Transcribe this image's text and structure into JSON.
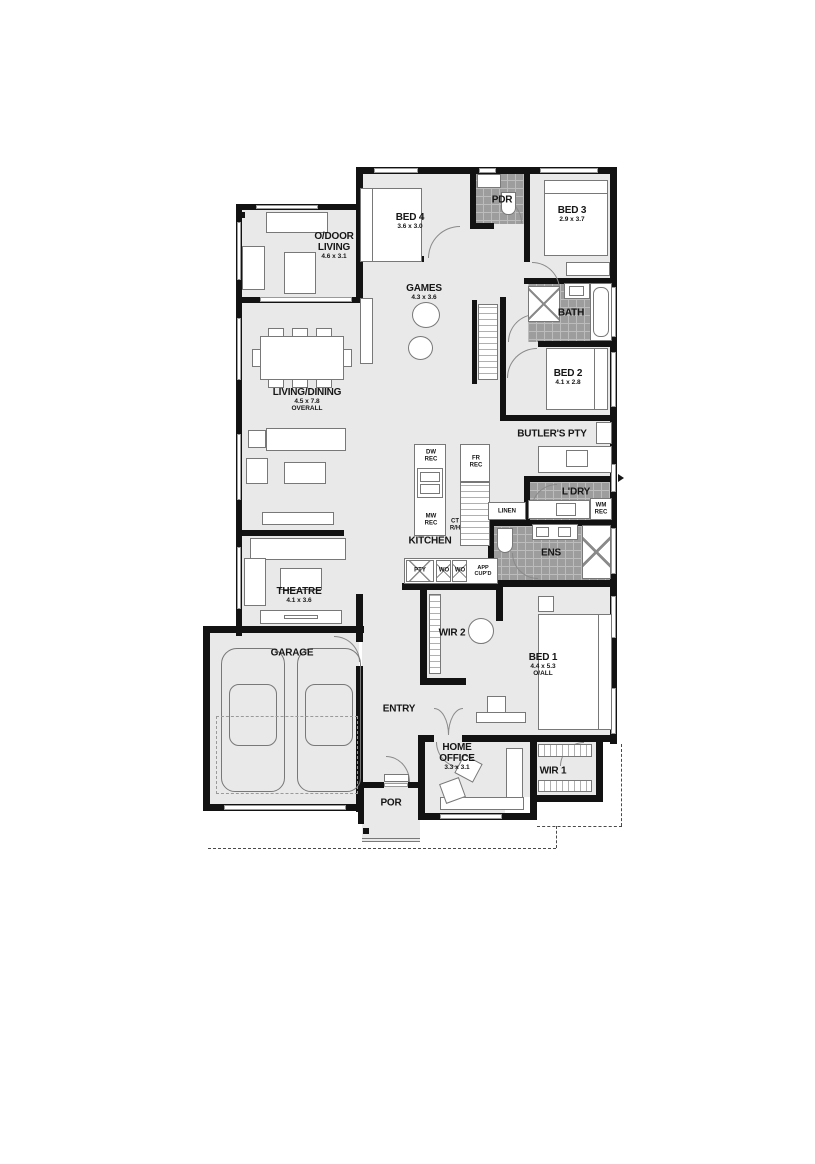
{
  "plan_title": "single-storey house floor plan",
  "colors": {
    "floor": "#e9e9e9",
    "wall": "#121212",
    "wet_area_tile": "#9d9d9d",
    "furniture_line": "#787878",
    "background": "#ffffff"
  },
  "rooms": {
    "odoor": {
      "l1": "O/DOOR",
      "l2": "LIVING",
      "dims": "4.6 x 3.1"
    },
    "bed4": {
      "name": "BED 4",
      "dims": "3.6 x 3.0"
    },
    "pdr": {
      "name": "PDR"
    },
    "bed3": {
      "name": "BED 3",
      "dims": "2.9 x 3.7"
    },
    "games": {
      "name": "GAMES",
      "dims": "4.3 x 3.6"
    },
    "bath": {
      "name": "BATH"
    },
    "living": {
      "name": "LIVING/DINING",
      "dims": "4.5 x 7.8",
      "dims2": "OVERALL"
    },
    "bed2": {
      "name": "BED 2",
      "dims": "4.1 x 2.8"
    },
    "butlers": {
      "name": "BUTLER'S PTY"
    },
    "ldry": {
      "name": "L'DRY"
    },
    "linen": {
      "name": "LINEN"
    },
    "kitchen": {
      "name": "KITCHEN"
    },
    "ens": {
      "name": "ENS"
    },
    "theatre": {
      "name": "THEATRE",
      "dims": "4.1 x 3.6"
    },
    "wir2": {
      "name": "WIR 2"
    },
    "bed1": {
      "name": "BED 1",
      "dims": "4.4 x 5.3",
      "dims2": "O/ALL"
    },
    "garage": {
      "name": "GARAGE"
    },
    "entry": {
      "name": "ENTRY"
    },
    "office": {
      "l1": "HOME",
      "l2": "OFFICE",
      "dims": "3.3 x 3.1"
    },
    "wir1": {
      "name": "WIR 1"
    },
    "por": {
      "name": "POR"
    }
  },
  "fixtures": {
    "dw": {
      "l1": "DW",
      "l2": "REC"
    },
    "fr": {
      "l1": "FR",
      "l2": "REC"
    },
    "mw": {
      "l1": "MW",
      "l2": "REC"
    },
    "ct": {
      "l1": "CT",
      "l2": "R/H"
    },
    "wm": {
      "l1": "WM",
      "l2": "REC"
    },
    "pty": {
      "name": "PTY"
    },
    "wo1": {
      "name": "WO"
    },
    "wo2": {
      "name": "WO"
    },
    "app": {
      "l1": "APP",
      "l2": "CUP'D"
    }
  }
}
